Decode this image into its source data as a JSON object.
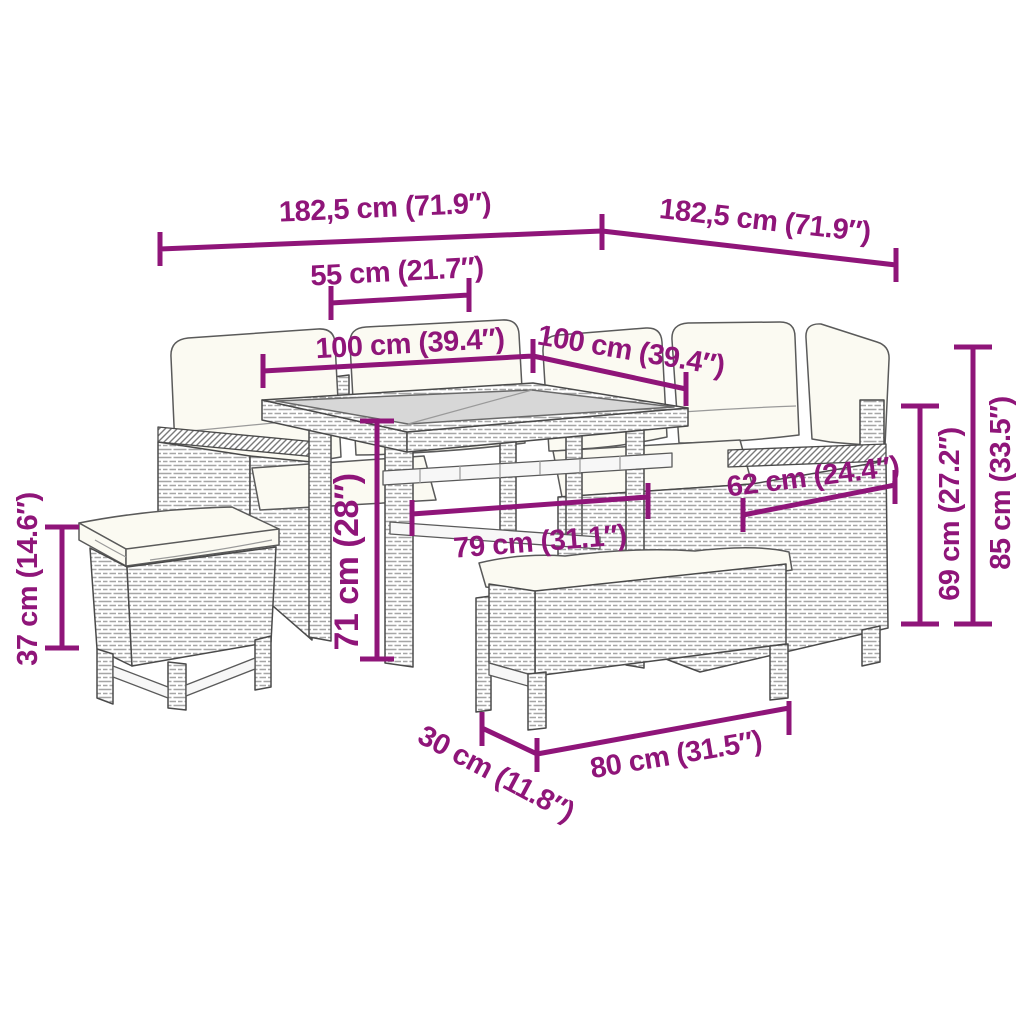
{
  "colors": {
    "accent": "#8F1579",
    "outline": "#4a4a4a",
    "glass": "#D7D7D7",
    "cushion": "#FBFAF2",
    "background": "#FFFFFF"
  },
  "figure": {
    "type": "product-dimension-diagram",
    "items": [
      "corner-sofa-left-section",
      "corner-sofa-right-section",
      "glass-top-dining-table",
      "stool-with-cushion",
      "bench-with-cushion"
    ]
  },
  "dimensions": [
    {
      "id": "sofa-left-length",
      "label": "182,5 cm (71.9″)"
    },
    {
      "id": "sofa-right-length",
      "label": "182,5 cm (71.9″)"
    },
    {
      "id": "table-half-top-width",
      "label": "55 cm (21.7″)"
    },
    {
      "id": "table-top-length-left",
      "label": "100 cm (39.4″)"
    },
    {
      "id": "table-top-length-right",
      "label": "100 cm (39.4″)"
    },
    {
      "id": "armrest-section-length",
      "label": "62 cm (24.4″)"
    },
    {
      "id": "under-table-clearance",
      "label": "79 cm (31.1″)"
    },
    {
      "id": "table-height",
      "label": "71 cm (28″)"
    },
    {
      "id": "armrest-height",
      "label": "69 cm (27.2″)"
    },
    {
      "id": "overall-height",
      "label": "85 cm (33.5″)"
    },
    {
      "id": "stool-height",
      "label": "37 cm (14.6″)"
    },
    {
      "id": "bench-depth",
      "label": "30 cm (11.8″)"
    },
    {
      "id": "bench-length",
      "label": "80 cm (31.5″)"
    }
  ]
}
